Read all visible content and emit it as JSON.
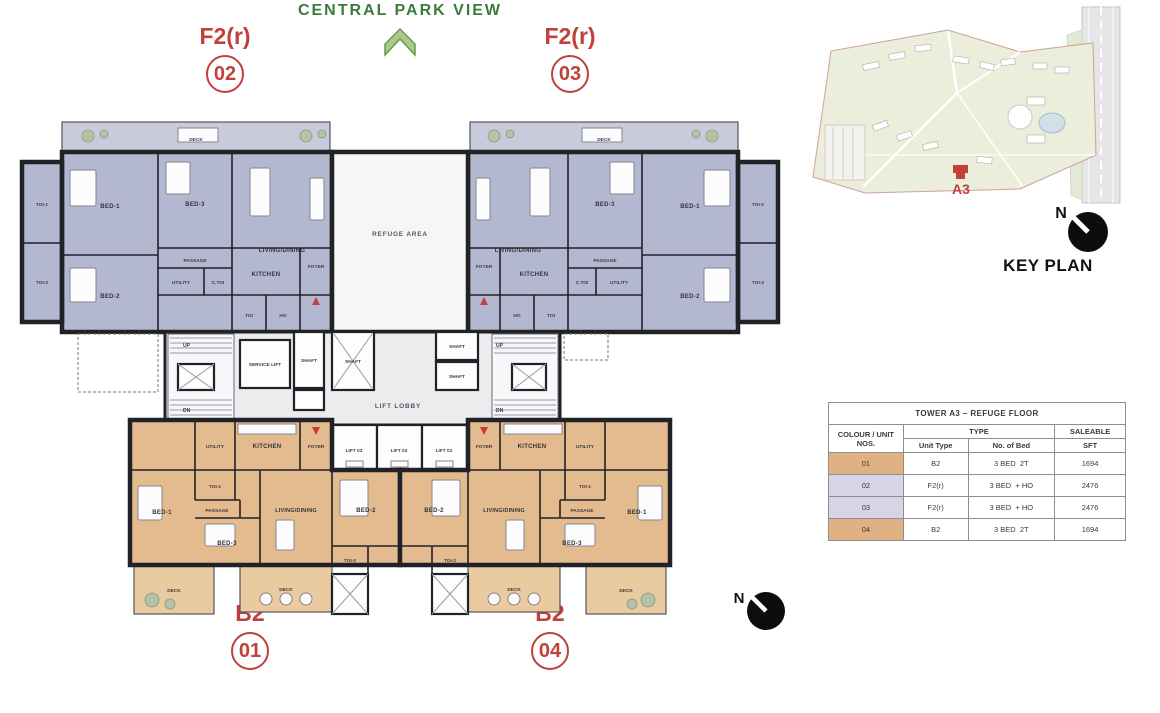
{
  "header": {
    "title": "CENTRAL PARK VIEW"
  },
  "units": {
    "top_left": {
      "type": "F2(r)",
      "number": "02"
    },
    "top_right": {
      "type": "F2(r)",
      "number": "03"
    },
    "bottom_left": {
      "type": "B2",
      "number": "01"
    },
    "bottom_right": {
      "type": "B2",
      "number": "04"
    }
  },
  "rooms": {
    "bed1": "BED-1",
    "bed2": "BED-2",
    "bed3": "BED-3",
    "living_dining": "LIVING/DINING",
    "kitchen": "KITCHEN",
    "passage": "PASSAGE",
    "utility": "UTILITY",
    "foyer": "FOYER",
    "deck": "DECK",
    "toi1": "TOI-1",
    "toi2": "TOI-2",
    "toi": "TOI",
    "c_toi": "C.TOI",
    "ho": "HO",
    "refuge_area": "REFUGE AREA",
    "lift_lobby": "LIFT LOBBY",
    "service_lift": "SERVICE LIFT",
    "shaft": "SHAFT",
    "up": "UP",
    "dn": "DN",
    "lift_01": "LIFT 01",
    "lift_02": "LIFT 02",
    "lift_03": "LIFT 03"
  },
  "key_plan": {
    "label": "KEY PLAN",
    "tower_marker": "A3",
    "north": "N"
  },
  "compass": {
    "north": "N"
  },
  "table": {
    "title": "TOWER A3 – REFUGE FLOOR",
    "headers": {
      "colour_unit": "COLOUR / UNIT NOS.",
      "type_group": "TYPE",
      "saleable": "SALEABLE",
      "unit_type": "Unit Type",
      "no_of_bed": "No. of Bed",
      "sft": "SFT"
    },
    "rows": [
      {
        "unit_no": "01",
        "unit_type": "B2",
        "no_of_bed": "3 BED  2T",
        "sft": "1694",
        "color": "#dfb183"
      },
      {
        "unit_no": "02",
        "unit_type": "F2(r)",
        "no_of_bed": "3 BED  + HO",
        "sft": "2476",
        "color": "#d6d4e6"
      },
      {
        "unit_no": "03",
        "unit_type": "F2(r)",
        "no_of_bed": "3 BED  + HO",
        "sft": "2476",
        "color": "#d6d4e6"
      },
      {
        "unit_no": "04",
        "unit_type": "B2",
        "no_of_bed": "3 BED  2T",
        "sft": "1694",
        "color": "#dfb183"
      }
    ]
  },
  "colors": {
    "unit_f2r_fill": "#b3b8d0",
    "unit_b2_fill": "#e4bb8e",
    "accent_red": "#c2403c",
    "title_green": "#3d7a3b",
    "wall": "#212128"
  }
}
